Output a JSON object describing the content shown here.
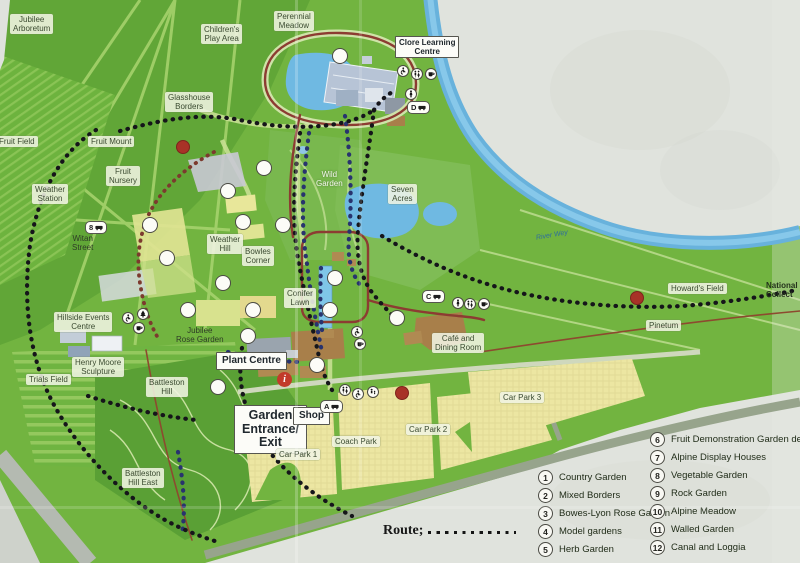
{
  "colors": {
    "map_green": "#72b440",
    "woodland_green": "#5aa035",
    "water_blue": "#6fb9e2",
    "river_blue": "#68b2dc",
    "car_park_yellow": "#ece6a2",
    "building_tan": "#a87f4a",
    "route_black": "#15151a",
    "route_navy": "#28336e",
    "route_maroon": "#8c3c32",
    "parking_red": "#a83227",
    "info_red": "#c23b2a",
    "paper": "#e0e3dd"
  },
  "map": {
    "info_label": "i",
    "labels": [
      {
        "name": "label-jubilee-arboretum",
        "cls": "box",
        "x": 10,
        "y": 14,
        "lines": [
          "Jubilee",
          "Arboretum"
        ]
      },
      {
        "name": "label-childrens-play-area",
        "cls": "box",
        "x": 201,
        "y": 24,
        "lines": [
          "Children's",
          "Play Area"
        ]
      },
      {
        "name": "label-perennial-meadow",
        "cls": "box",
        "x": 274,
        "y": 11,
        "lines": [
          "Perennial",
          "Meadow"
        ]
      },
      {
        "name": "label-clore-learning-centre",
        "cls": "frame-sm",
        "x": 395,
        "y": 36,
        "lines": [
          "Clore Learning",
          "Centre"
        ]
      },
      {
        "name": "label-glasshouse-borders",
        "cls": "box",
        "x": 165,
        "y": 92,
        "lines": [
          "Glasshouse",
          "Borders"
        ]
      },
      {
        "name": "label-fruit-field",
        "cls": "box",
        "x": -4,
        "y": 136,
        "lines": [
          "Fruit Field"
        ]
      },
      {
        "name": "label-fruit-mount",
        "cls": "box",
        "x": 88,
        "y": 136,
        "lines": [
          "Fruit Mount"
        ]
      },
      {
        "name": "label-fruit-nursery",
        "cls": "box",
        "x": 106,
        "y": 166,
        "lines": [
          "Fruit",
          "Nursery"
        ]
      },
      {
        "name": "label-weather-station",
        "cls": "box",
        "x": 32,
        "y": 184,
        "lines": [
          "Weather",
          "Station"
        ]
      },
      {
        "name": "label-witan-street",
        "cls": "plain",
        "x": 72,
        "y": 234,
        "lines": [
          "Witan",
          "Street"
        ]
      },
      {
        "name": "label-weather-hill",
        "cls": "box",
        "x": 207,
        "y": 234,
        "lines": [
          "Weather",
          "Hill"
        ]
      },
      {
        "name": "label-bowles-corner",
        "cls": "box",
        "x": 242,
        "y": 246,
        "lines": [
          "Bowles",
          "Corner"
        ]
      },
      {
        "name": "label-wild-garden",
        "cls": "white",
        "x": 316,
        "y": 170,
        "lines": [
          "Wild",
          "Garden"
        ]
      },
      {
        "name": "label-seven-acres",
        "cls": "box",
        "x": 388,
        "y": 184,
        "lines": [
          "Seven",
          "Acres"
        ]
      },
      {
        "name": "label-river-wey",
        "cls": "blue",
        "x": 536,
        "y": 232,
        "lines": [
          "River Wey"
        ],
        "rot": -10
      },
      {
        "name": "label-howards-field",
        "cls": "box",
        "x": 668,
        "y": 283,
        "lines": [
          "Howard's Field"
        ]
      },
      {
        "name": "label-national-collection",
        "cls": "natl",
        "x": 766,
        "y": 281,
        "lines": [
          "National H",
          "Collect"
        ]
      },
      {
        "name": "label-pinetum",
        "cls": "box",
        "x": 646,
        "y": 320,
        "lines": [
          "Pinetum"
        ]
      },
      {
        "name": "label-conifer-lawn",
        "cls": "box",
        "x": 284,
        "y": 288,
        "lines": [
          "Conifer",
          "Lawn"
        ]
      },
      {
        "name": "label-hillside-events-centre",
        "cls": "box",
        "x": 54,
        "y": 312,
        "lines": [
          "Hillside Events",
          "Centre"
        ]
      },
      {
        "name": "label-jubilee-rose-garden",
        "cls": "plain",
        "x": 176,
        "y": 326,
        "lines": [
          "Jubilee",
          "Rose Garden"
        ]
      },
      {
        "name": "label-henry-moore-sculpture",
        "cls": "box",
        "x": 72,
        "y": 357,
        "lines": [
          "Henry Moore",
          "Sculpture"
        ]
      },
      {
        "name": "label-trials-field",
        "cls": "box",
        "x": 26,
        "y": 374,
        "lines": [
          "Trials Field"
        ]
      },
      {
        "name": "label-battleston-hill",
        "cls": "box",
        "x": 146,
        "y": 377,
        "lines": [
          "Battleston",
          "Hill"
        ]
      },
      {
        "name": "label-battleston-hill-east",
        "cls": "box",
        "x": 122,
        "y": 468,
        "lines": [
          "Battleston",
          "Hill East"
        ]
      },
      {
        "name": "label-plant-centre",
        "cls": "frame",
        "x": 216,
        "y": 352,
        "lines": [
          "Plant Centre"
        ]
      },
      {
        "name": "label-garden-entrance-exit",
        "cls": "frame-lg",
        "x": 234,
        "y": 405,
        "lines": [
          "Garden",
          "Entrance/",
          "Exit"
        ]
      },
      {
        "name": "label-shop",
        "cls": "frame",
        "x": 293,
        "y": 407,
        "lines": [
          "Shop"
        ]
      },
      {
        "name": "label-cafe-dining-room",
        "cls": "box",
        "x": 432,
        "y": 333,
        "lines": [
          "Café and",
          "Dining Room"
        ]
      },
      {
        "name": "label-coach-park",
        "cls": "box",
        "x": 332,
        "y": 436,
        "lines": [
          "Coach Park"
        ]
      },
      {
        "name": "label-car-park-1",
        "cls": "box",
        "x": 276,
        "y": 449,
        "lines": [
          "Car Park 1"
        ]
      },
      {
        "name": "label-car-park-2",
        "cls": "box",
        "x": 406,
        "y": 424,
        "lines": [
          "Car Park 2"
        ]
      },
      {
        "name": "label-car-park-3",
        "cls": "box",
        "x": 500,
        "y": 392,
        "lines": [
          "Car Park 3"
        ]
      }
    ],
    "markers": [
      {
        "name": "marker-1",
        "n": "1",
        "x": 253,
        "y": 310
      },
      {
        "name": "marker-2",
        "n": "2",
        "x": 248,
        "y": 336
      },
      {
        "name": "marker-3",
        "n": "3",
        "x": 223,
        "y": 283
      },
      {
        "name": "marker-4",
        "n": "4",
        "x": 188,
        "y": 310
      },
      {
        "name": "marker-5",
        "n": "5",
        "x": 167,
        "y": 258
      },
      {
        "name": "marker-6",
        "n": "6",
        "x": 150,
        "y": 225
      },
      {
        "name": "marker-7",
        "n": "7",
        "x": 228,
        "y": 191
      },
      {
        "name": "marker-8",
        "n": "8",
        "x": 243,
        "y": 222
      },
      {
        "name": "marker-9",
        "n": "9",
        "x": 264,
        "y": 168
      },
      {
        "name": "marker-10",
        "n": "10",
        "x": 283,
        "y": 225
      },
      {
        "name": "marker-11",
        "n": "11",
        "x": 335,
        "y": 278
      },
      {
        "name": "marker-12",
        "n": "12",
        "x": 330,
        "y": 310
      },
      {
        "name": "marker-13",
        "n": "13",
        "x": 218,
        "y": 387
      },
      {
        "name": "marker-14",
        "n": "14",
        "x": 397,
        "y": 318
      },
      {
        "name": "marker-15",
        "n": "15",
        "x": 317,
        "y": 365
      },
      {
        "name": "marker-16",
        "n": "16",
        "x": 340,
        "y": 56
      }
    ],
    "parking": [
      {
        "name": "parking-fruit-nursery",
        "label": "P",
        "x": 183,
        "y": 147
      },
      {
        "name": "parking-entrance",
        "label": "P",
        "x": 402,
        "y": 393
      },
      {
        "name": "parking-howards-field",
        "label": "P",
        "x": 637,
        "y": 298
      }
    ],
    "stops": [
      {
        "name": "bus-stop-8",
        "label": "8",
        "x": 85,
        "y": 221
      },
      {
        "name": "bus-stop-d",
        "label": "D",
        "x": 407,
        "y": 101
      },
      {
        "name": "bus-stop-c",
        "label": "C",
        "x": 422,
        "y": 290
      },
      {
        "name": "bus-stop-a",
        "label": "A",
        "x": 320,
        "y": 400
      }
    ],
    "amenities": [
      {
        "name": "wheelchair-icon",
        "icon": "wheelchair",
        "x": 397,
        "y": 65
      },
      {
        "name": "toilets-icon",
        "icon": "toilets",
        "x": 411,
        "y": 68
      },
      {
        "name": "refreshments-icon",
        "icon": "cup",
        "x": 425,
        "y": 68
      },
      {
        "name": "person-icon",
        "icon": "person",
        "x": 405,
        "y": 88
      },
      {
        "name": "wheelchair-icon",
        "icon": "wheelchair",
        "x": 122,
        "y": 312
      },
      {
        "name": "picnic-tree-icon",
        "icon": "tree",
        "x": 137,
        "y": 308
      },
      {
        "name": "refreshments-icon",
        "icon": "cup",
        "x": 133,
        "y": 322
      },
      {
        "name": "wheelchair-icon",
        "icon": "wheelchair",
        "x": 351,
        "y": 326
      },
      {
        "name": "refreshments-icon",
        "icon": "cup",
        "x": 354,
        "y": 338
      },
      {
        "name": "toilets-icon",
        "icon": "toilets",
        "x": 339,
        "y": 384
      },
      {
        "name": "wheelchair-icon",
        "icon": "wheelchair",
        "x": 352,
        "y": 388
      },
      {
        "name": "baby-change-icon",
        "icon": "baby",
        "x": 367,
        "y": 386
      },
      {
        "name": "person-icon",
        "icon": "person",
        "x": 452,
        "y": 297
      },
      {
        "name": "toilets-icon",
        "icon": "toilets",
        "x": 464,
        "y": 298
      },
      {
        "name": "refreshments-icon",
        "icon": "cup",
        "x": 478,
        "y": 298
      }
    ]
  },
  "legend": {
    "column1": [
      {
        "num": "1",
        "label": "Country Garden"
      },
      {
        "num": "2",
        "label": "Mixed Borders"
      },
      {
        "num": "3",
        "label": "Bowes-Lyon Rose Garden"
      },
      {
        "num": "4",
        "label": "Model gardens"
      },
      {
        "num": "5",
        "label": "Herb Garden"
      }
    ],
    "column2": [
      {
        "num": "6",
        "label": "Fruit Demonstration Garden de"
      },
      {
        "num": "7",
        "label": "Alpine Display Houses"
      },
      {
        "num": "8",
        "label": "Vegetable Garden"
      },
      {
        "num": "9",
        "label": "Rock Garden"
      },
      {
        "num": "10",
        "label": "Alpine Meadow"
      },
      {
        "num": "11",
        "label": "Walled Garden"
      },
      {
        "num": "12",
        "label": "Canal and Loggia"
      }
    ],
    "route_label": "Route;",
    "scale_ticks": [
      {
        "t": "0",
        "x": 0
      },
      {
        "t": "50",
        "x": 23
      },
      {
        "t": "100",
        "x": 47
      },
      {
        "t": "150 metres",
        "x": 74
      }
    ]
  }
}
